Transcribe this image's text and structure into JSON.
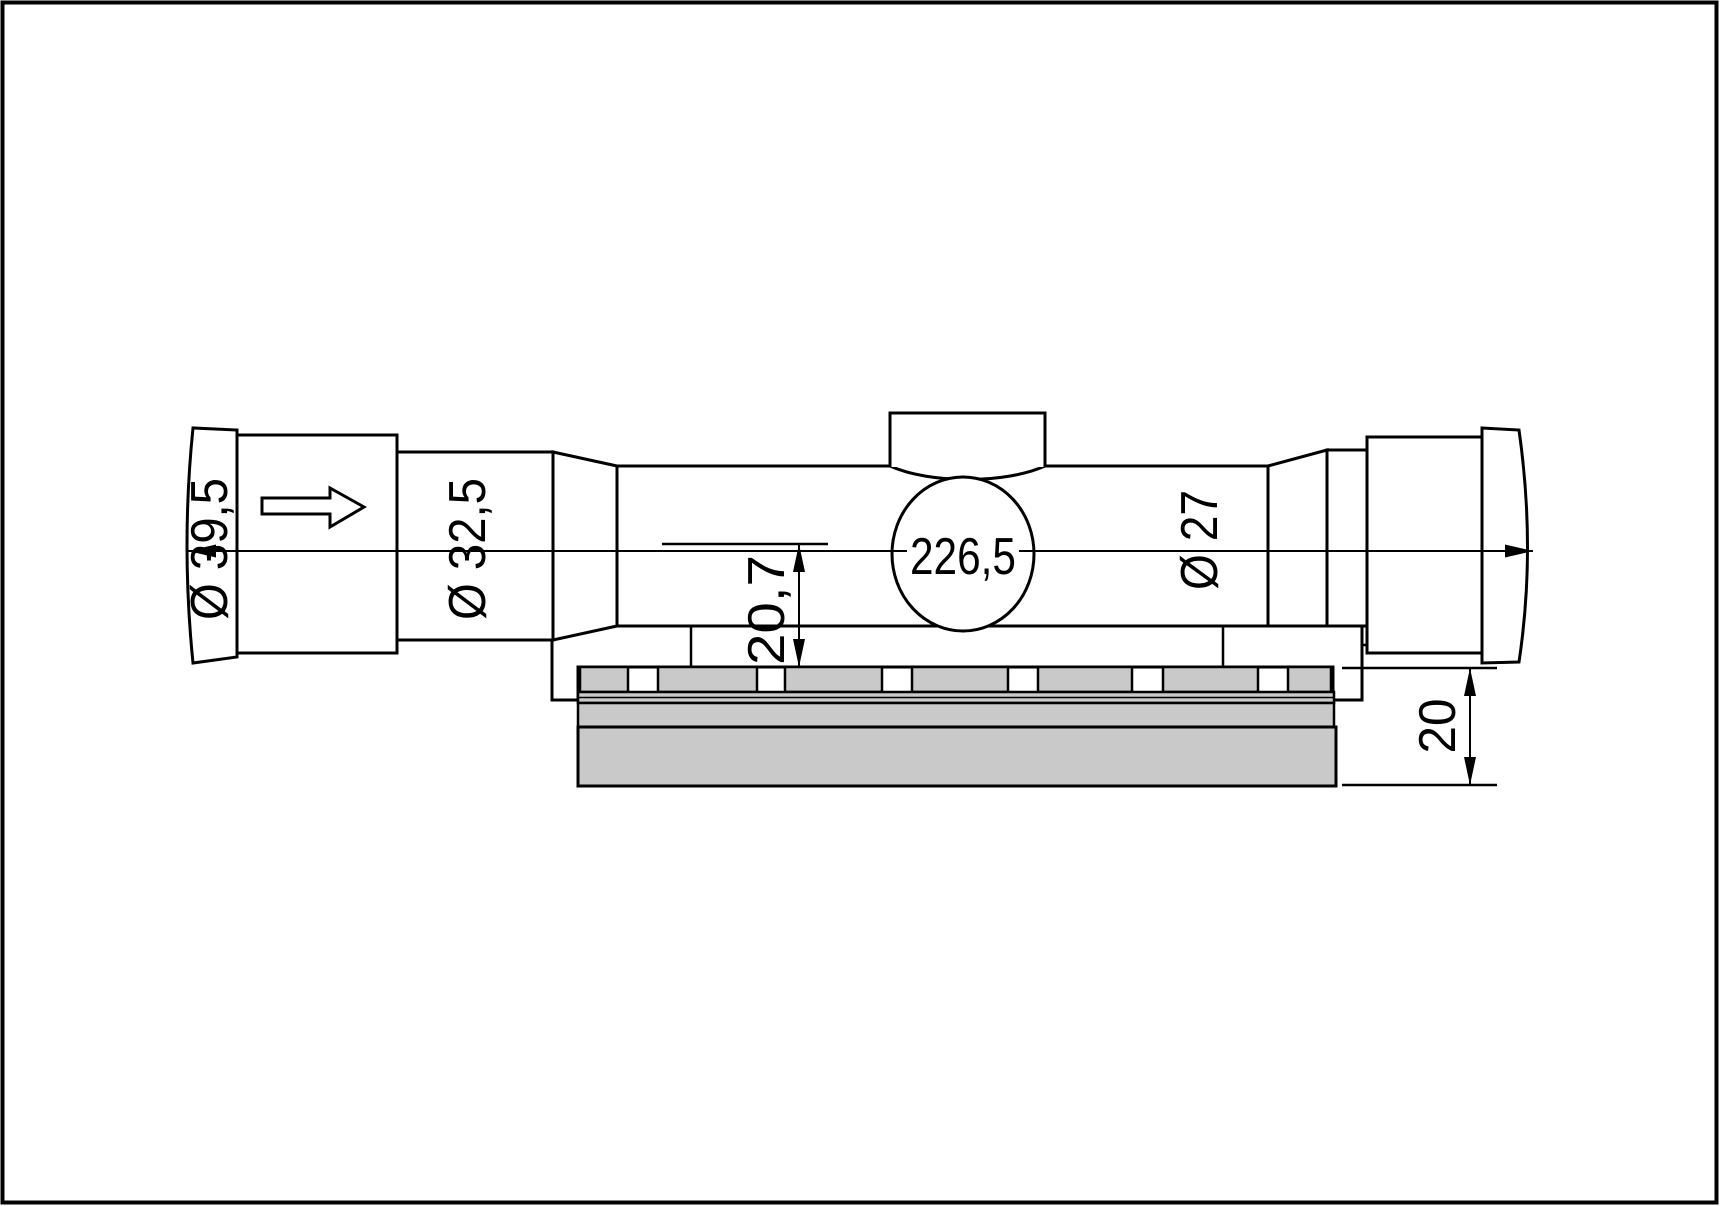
{
  "drawing": {
    "labels": {
      "overall_length": "226,5",
      "eyepiece_diameter": "Ø 39,5",
      "ocular_housing_diameter": "Ø 32,5",
      "main_tube_diameter": "Ø 27",
      "axis_height_over_rail": "20,7",
      "mount_height": "20"
    },
    "colors": {
      "line": "#000000",
      "metal_fill": "#c9c9c9",
      "background": "#ffffff"
    },
    "icons": {
      "direction_arrow": "right-arrow"
    }
  }
}
